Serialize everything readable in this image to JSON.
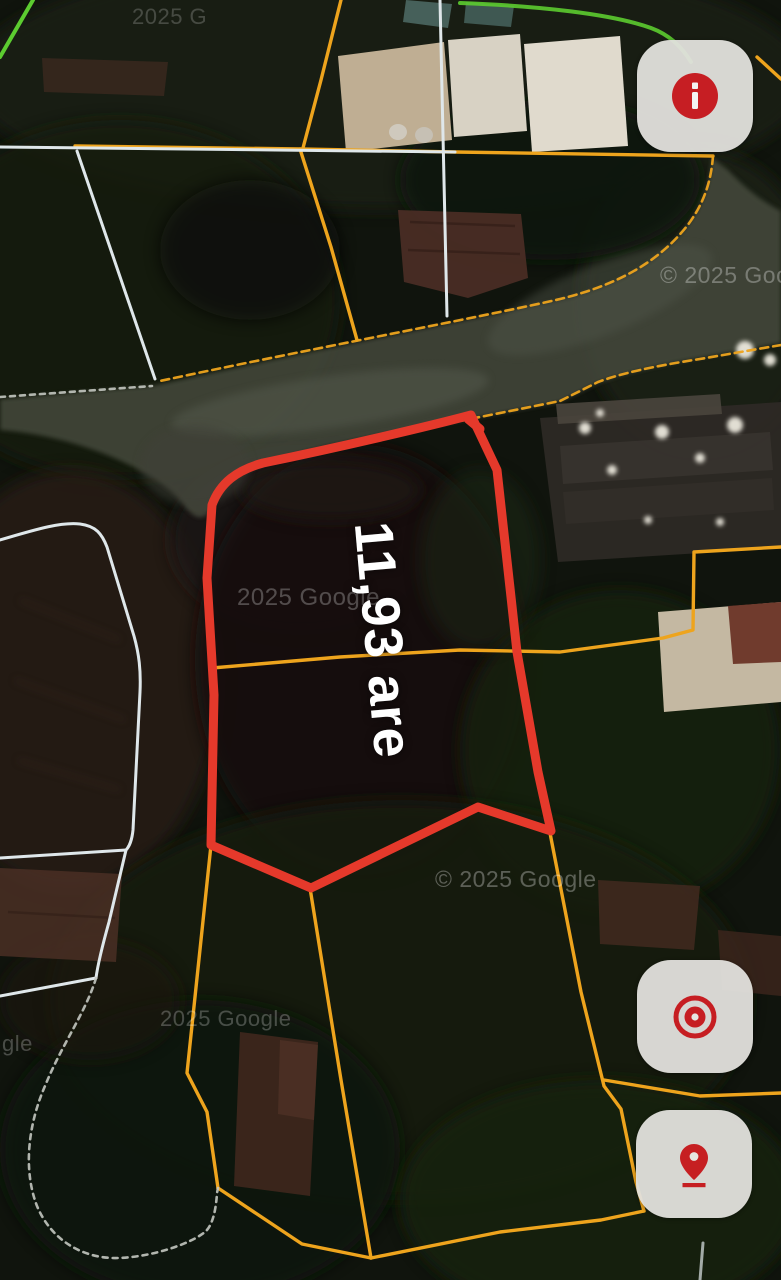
{
  "map": {
    "area_label": "11,93 are",
    "watermarks": {
      "top_left": "2025 G",
      "top_right": "© 2025 Goo",
      "center": "2025 Google",
      "middle": "© 2025 Google",
      "bottom": "2025 Google",
      "bottom_tail": "gle"
    }
  },
  "controls": {
    "info": {
      "icon": "info-icon"
    },
    "locate": {
      "icon": "target-icon"
    },
    "pin": {
      "icon": "location-pin-icon"
    }
  },
  "colors": {
    "marker-red": "#e5392b",
    "boundary-orange": "#eea41d",
    "boundary-white": "#dfe7ea",
    "boundary-gray": "#c3c7c0",
    "boundary-green": "#5ccc30",
    "icon-red": "#d01f24",
    "button-bg": "#e2e1dd",
    "label-white": "#ffffff",
    "watermark-white": "#ffffff"
  }
}
